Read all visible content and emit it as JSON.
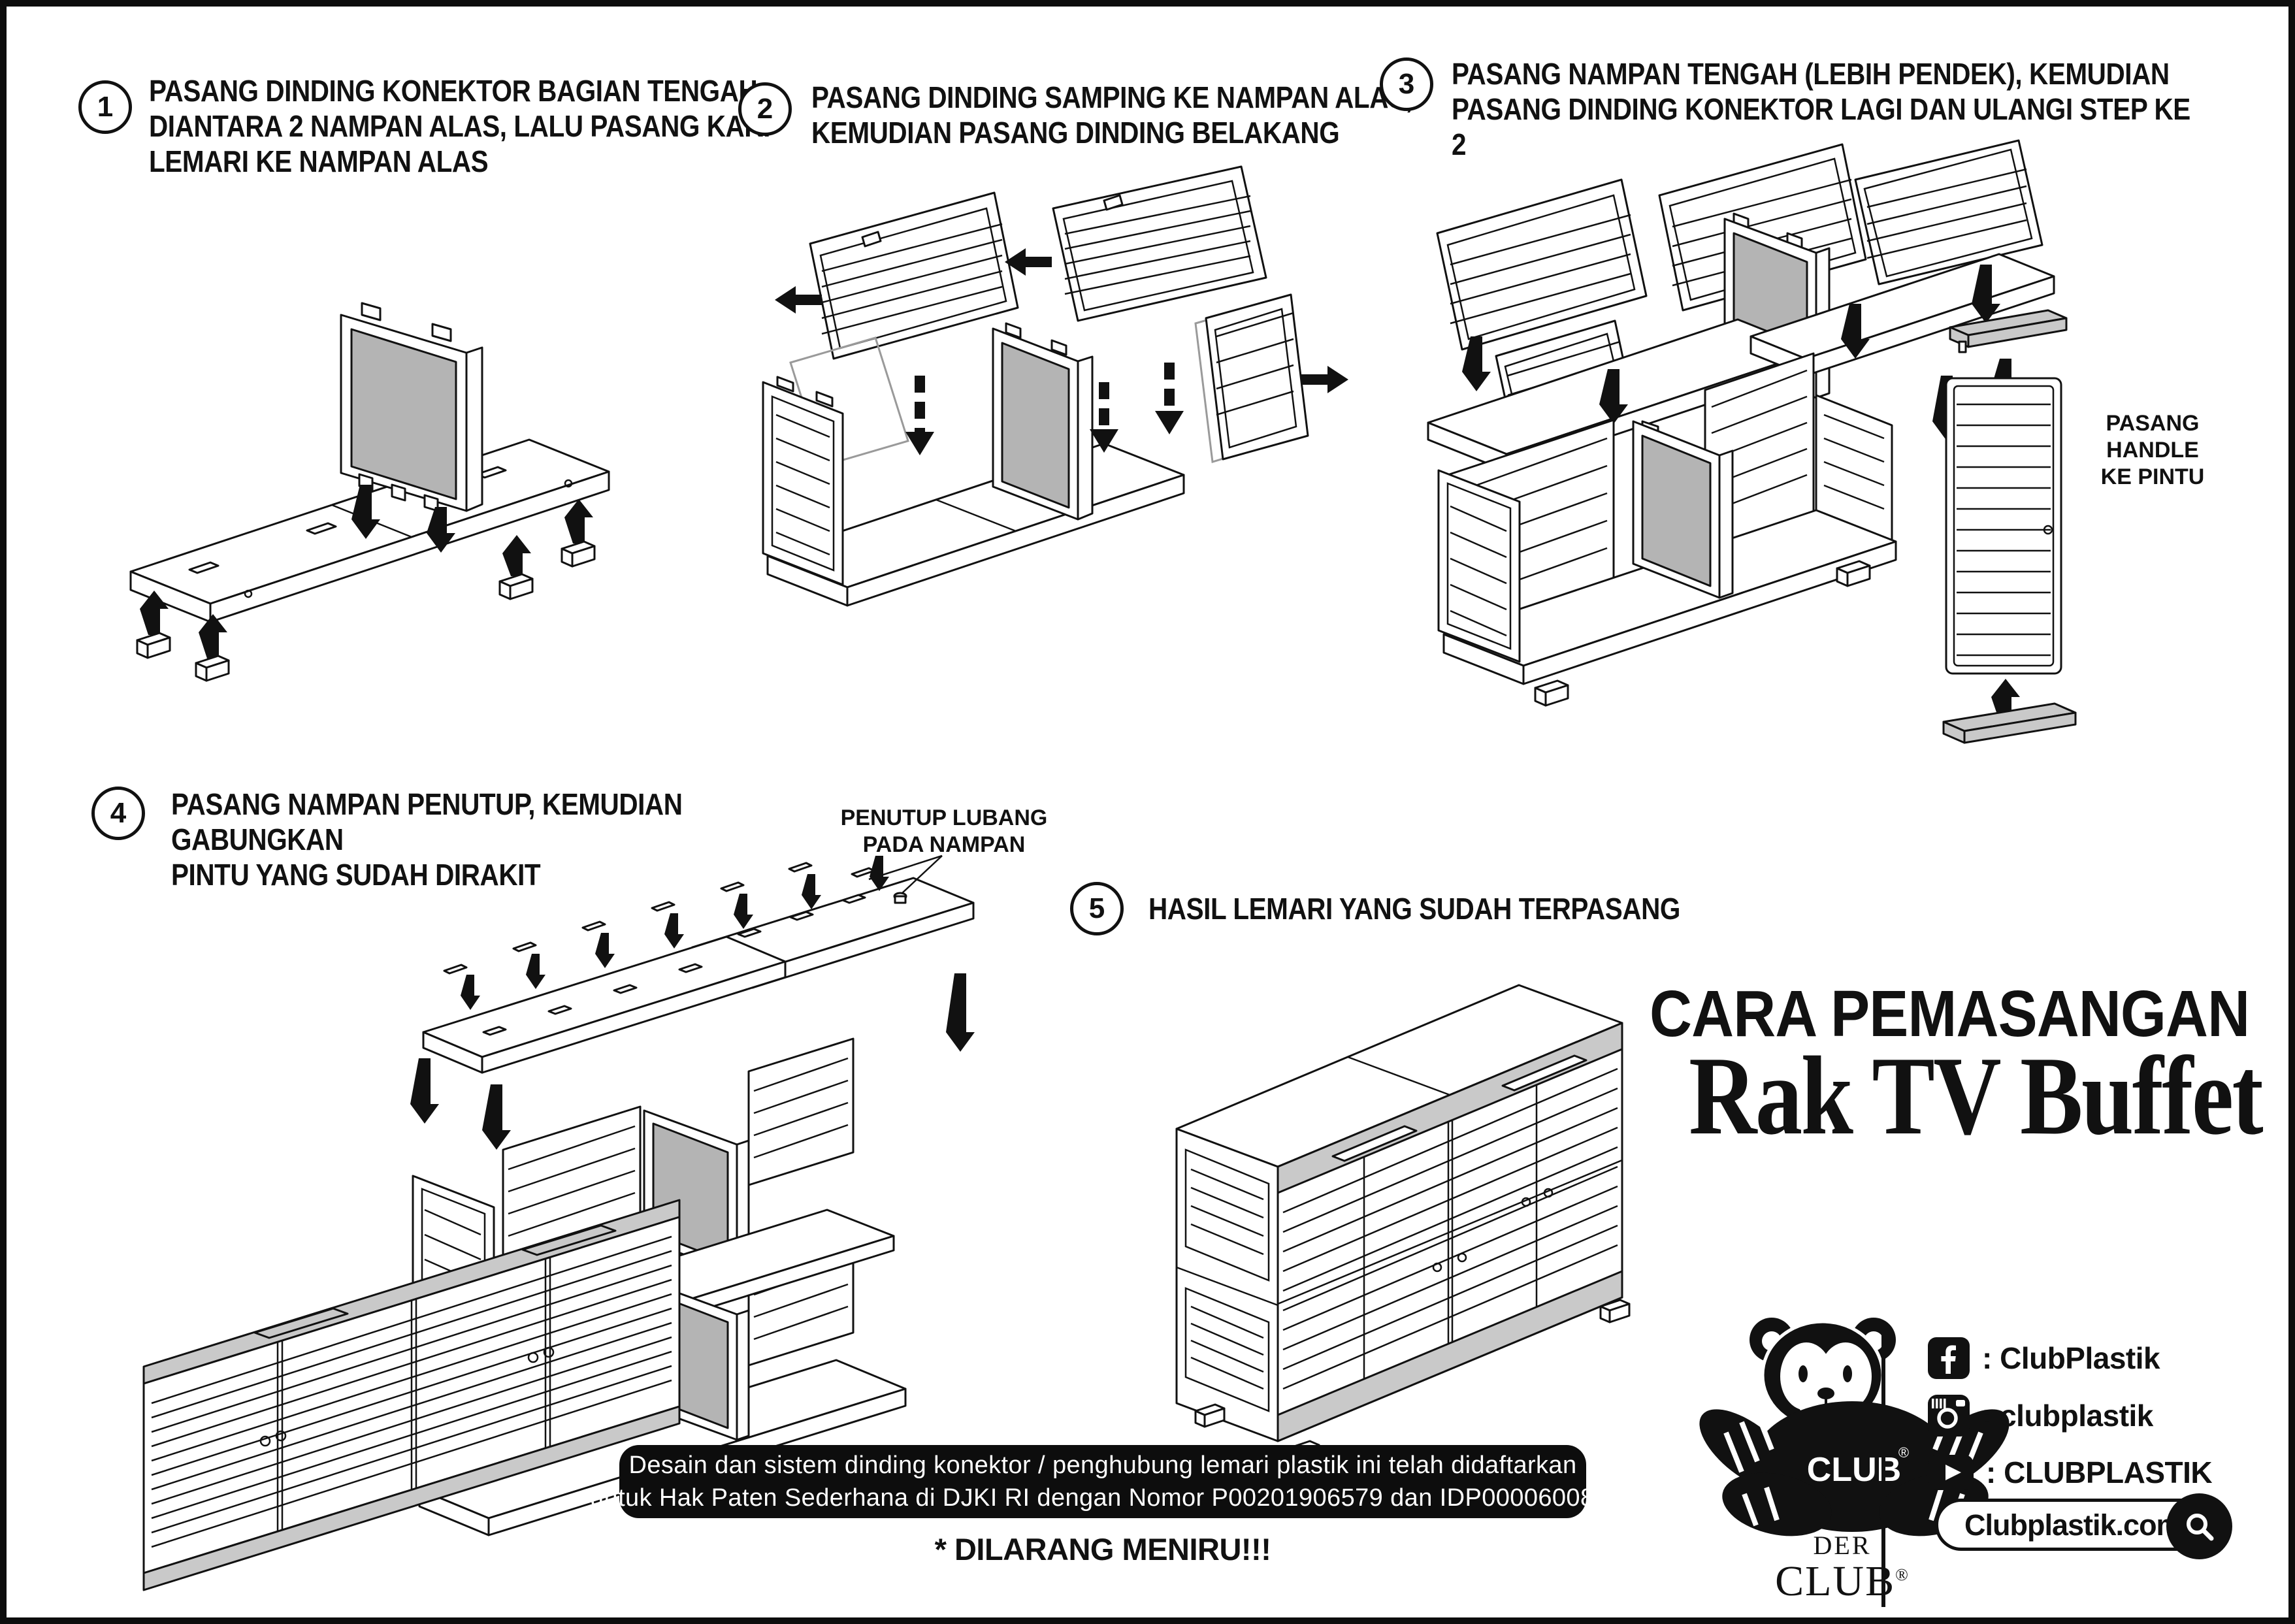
{
  "page": {
    "background": "#ffffff",
    "border_color": "#0d0d0d"
  },
  "steps": [
    {
      "num": "1",
      "text": "PASANG DINDING KONEKTOR BAGIAN TENGAH\nDIANTARA 2 NAMPAN ALAS, LALU PASANG KAKI\nLEMARI KE NAMPAN ALAS"
    },
    {
      "num": "2",
      "text": "PASANG DINDING SAMPING KE NAMPAN ALAS,\nKEMUDIAN PASANG DINDING BELAKANG"
    },
    {
      "num": "3",
      "text": "PASANG NAMPAN TENGAH (LEBIH PENDEK), KEMUDIAN\nPASANG DINDING KONEKTOR LAGI DAN ULANGI STEP KE 2"
    },
    {
      "num": "4",
      "text": "PASANG NAMPAN PENUTUP, KEMUDIAN GABUNGKAN\nPINTU YANG SUDAH DIRAKIT"
    },
    {
      "num": "5",
      "text": "HASIL LEMARI YANG SUDAH TERPASANG"
    }
  ],
  "callouts": {
    "handle": "PASANG HANDLE\nKE PINTU",
    "hole_cover": "PENUTUP LUBANG\nPADA NAMPAN"
  },
  "title": {
    "heading": "CARA PEMASANGAN",
    "product": "Rak TV Buffet"
  },
  "patent": {
    "line1": "Desain dan sistem dinding konektor / penghubung lemari plastik ini telah didaftarkan",
    "line2": "untuk Hak Paten Sederhana di DJKI RI dengan Nomor P00201906579 dan IDP000060085.",
    "warning": "* DILARANG MENIRU!!!"
  },
  "brand": {
    "der": "DER",
    "club": "CLUB",
    "registered": "®",
    "shirt": "CLUB",
    "social": [
      {
        "icon": "facebook-icon",
        "handle": ": ClubPlastik"
      },
      {
        "icon": "instagram-icon",
        "handle": ": clubplastik"
      },
      {
        "icon": "youtube-icon",
        "handle": ": CLUBPLASTIK"
      }
    ],
    "website": "Clubplastik.com"
  },
  "colors": {
    "connector_gray": "#b4b4b4",
    "rail_gray": "#c9c9c9",
    "ink": "#111111"
  }
}
